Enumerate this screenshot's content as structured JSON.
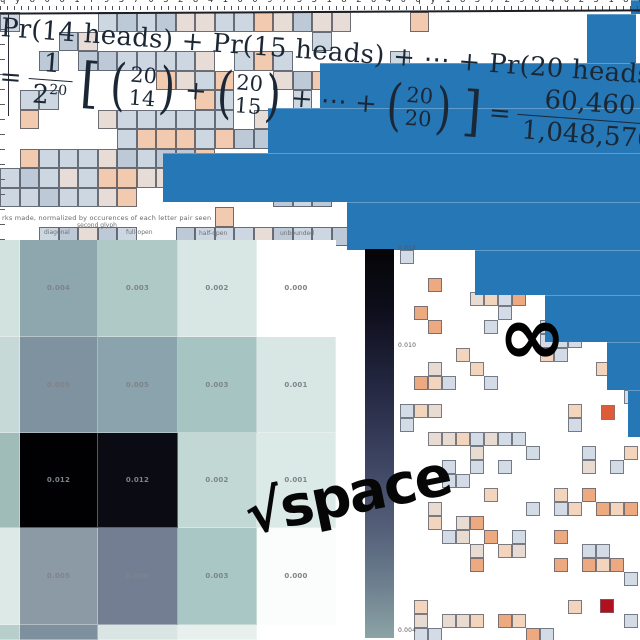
{
  "page": {
    "width": 640,
    "height": 640,
    "background": "#ffffff"
  },
  "colors": {
    "bar_blue": "#2577b6",
    "formula_ink": "#1c2735",
    "colorbar_top": "#050507",
    "colorbar_bottom": "#8ba4a6",
    "heatmap_black": "#010103",
    "deep_red": "#b0111f",
    "red_orange": "#de5b38"
  },
  "top_edge": {
    "text": "q y 8 0 6 1 f 9 3 7 0 5 2 8 4 1 6 0 9 7 3 5 1 8 2 6 4 0 q y 1 8 3 7 2 9 0 4 6 2 5 1 8 0 3 9 7 2 4 6 1 5 y 7"
  },
  "formula": {
    "line1": "Pr(14 heads) + Pr(15 heads) + ⋯ + Pr(20 heads)",
    "eq": "=",
    "frac1_num": "1",
    "frac1_den": "2",
    "frac1_den_exp": "20",
    "lbracket": "[",
    "lparen": "(",
    "rparen": ")",
    "binom1_top": "20",
    "binom1_bot": "14",
    "plus": "+",
    "binom2_top": "20",
    "binom2_bot": "15",
    "dots": "+ ⋯ +",
    "binom3_top": "20",
    "binom3_bot": "20",
    "rbracket": "]",
    "eq2": "=",
    "frac2_num": "60,460",
    "frac2_den": "1,048,576",
    "approx": "≈ 0.058"
  },
  "annotations": {
    "infinity": "∞",
    "sqrt_space": "√space"
  },
  "chart_data": [
    {
      "type": "bar",
      "title": "",
      "note": "right-aligned horizontal blue staircase, no visible axes",
      "color": "#2577b6",
      "bars": [
        {
          "left": 631,
          "top": 0,
          "h": 14,
          "right": 640
        },
        {
          "left": 587,
          "top": 14,
          "h": 49,
          "right": 636
        },
        {
          "left": 320,
          "top": 63,
          "h": 45,
          "right": 640
        },
        {
          "left": 268,
          "top": 108,
          "h": 45,
          "right": 640
        },
        {
          "left": 163,
          "top": 153,
          "h": 49,
          "right": 640
        },
        {
          "left": 347,
          "top": 202,
          "h": 48,
          "right": 640
        },
        {
          "left": 475,
          "top": 250,
          "h": 45,
          "right": 640
        },
        {
          "left": 545,
          "top": 295,
          "h": 47,
          "right": 640
        },
        {
          "left": 607,
          "top": 342,
          "h": 48,
          "right": 640
        },
        {
          "left": 628,
          "top": 390,
          "h": 47,
          "right": 640
        }
      ]
    },
    {
      "type": "heatmap",
      "caption": "rks made, normalized by occurences of each letter pair seen",
      "col_labels": [
        {
          "label": "diagonal",
          "x": 44,
          "y": 229
        },
        {
          "label": "second glyph",
          "x": 77,
          "y": 222
        },
        {
          "label": "full-open",
          "x": 126,
          "y": 229
        },
        {
          "label": "half-open",
          "x": 199,
          "y": 230
        },
        {
          "label": "unbounded",
          "x": 280,
          "y": 230
        }
      ],
      "values": [
        [
          "0.004",
          "0.003",
          "0.002",
          "0.000"
        ],
        [
          "0.005",
          "0.005",
          "0.003",
          "0.001"
        ],
        [
          "0.012",
          "0.012",
          "0.002",
          "0.001"
        ],
        [
          "0.005",
          "0.006",
          "0.003",
          "0.000"
        ]
      ],
      "cell_colors": [
        [
          "#d2e2df",
          "#8ea6ad",
          "#afc9c6",
          "#d9e7e4",
          "#ffffff"
        ],
        [
          "#c6d9d6",
          "#7e929f",
          "#8ba3ac",
          "#a6c4c1",
          "#d9e7e4"
        ],
        [
          "#9fbcb8",
          "#010103",
          "#0b0b13",
          "#c2d8d5",
          "#dceae7"
        ],
        [
          "#dce9e6",
          "#8c9aa6",
          "#747e93",
          "#a9c7c4",
          "#fbfdfc"
        ],
        [
          "#b7cecb",
          "#7e8f9e",
          "#d8e5e2",
          "#e8f0ee",
          "#ffffff"
        ]
      ],
      "geometry": {
        "x": 0,
        "y": 240,
        "col_widths": [
          20,
          78,
          80,
          79,
          79
        ],
        "row_heights": [
          97,
          96,
          95,
          97,
          15
        ]
      }
    },
    {
      "type": "colorbar",
      "ticks": [
        {
          "label": "0.012",
          "y": 245
        },
        {
          "label": "0.010",
          "y": 342
        },
        {
          "label": "0.004",
          "y": 627
        }
      ]
    }
  ],
  "decor": {
    "top_grid": {
      "x": 0,
      "y": 12,
      "cols": 30,
      "rows": 12,
      "cell": 19.5,
      "p": 0.34,
      "p_sparse": 0.12,
      "sparse_after_x": 345,
      "sparse_cut_y": 60,
      "palette": [
        "#ccd7e1",
        "#ccd7e1",
        "#ccd7e1",
        "#bdc9d6",
        "#f2cab0",
        "#e7ddd6"
      ],
      "seed": 7
    },
    "right_grid": {
      "x": 400,
      "y": 250,
      "cols": 17,
      "rows": 28,
      "cell": 14,
      "p": 0.2,
      "palette": [
        "#d3dbe7",
        "#d3dbe7",
        "#d3dbe7",
        "#f3d4bd",
        "#f3d4bd",
        "#edaa80",
        "#e8dcd2"
      ],
      "seed": 23
    },
    "special_cells": [
      {
        "x": 601,
        "y": 405,
        "w": 14,
        "h": 15,
        "color": "#de5b38"
      },
      {
        "x": 600,
        "y": 599,
        "w": 14,
        "h": 14,
        "color": "#b0111f"
      }
    ]
  }
}
